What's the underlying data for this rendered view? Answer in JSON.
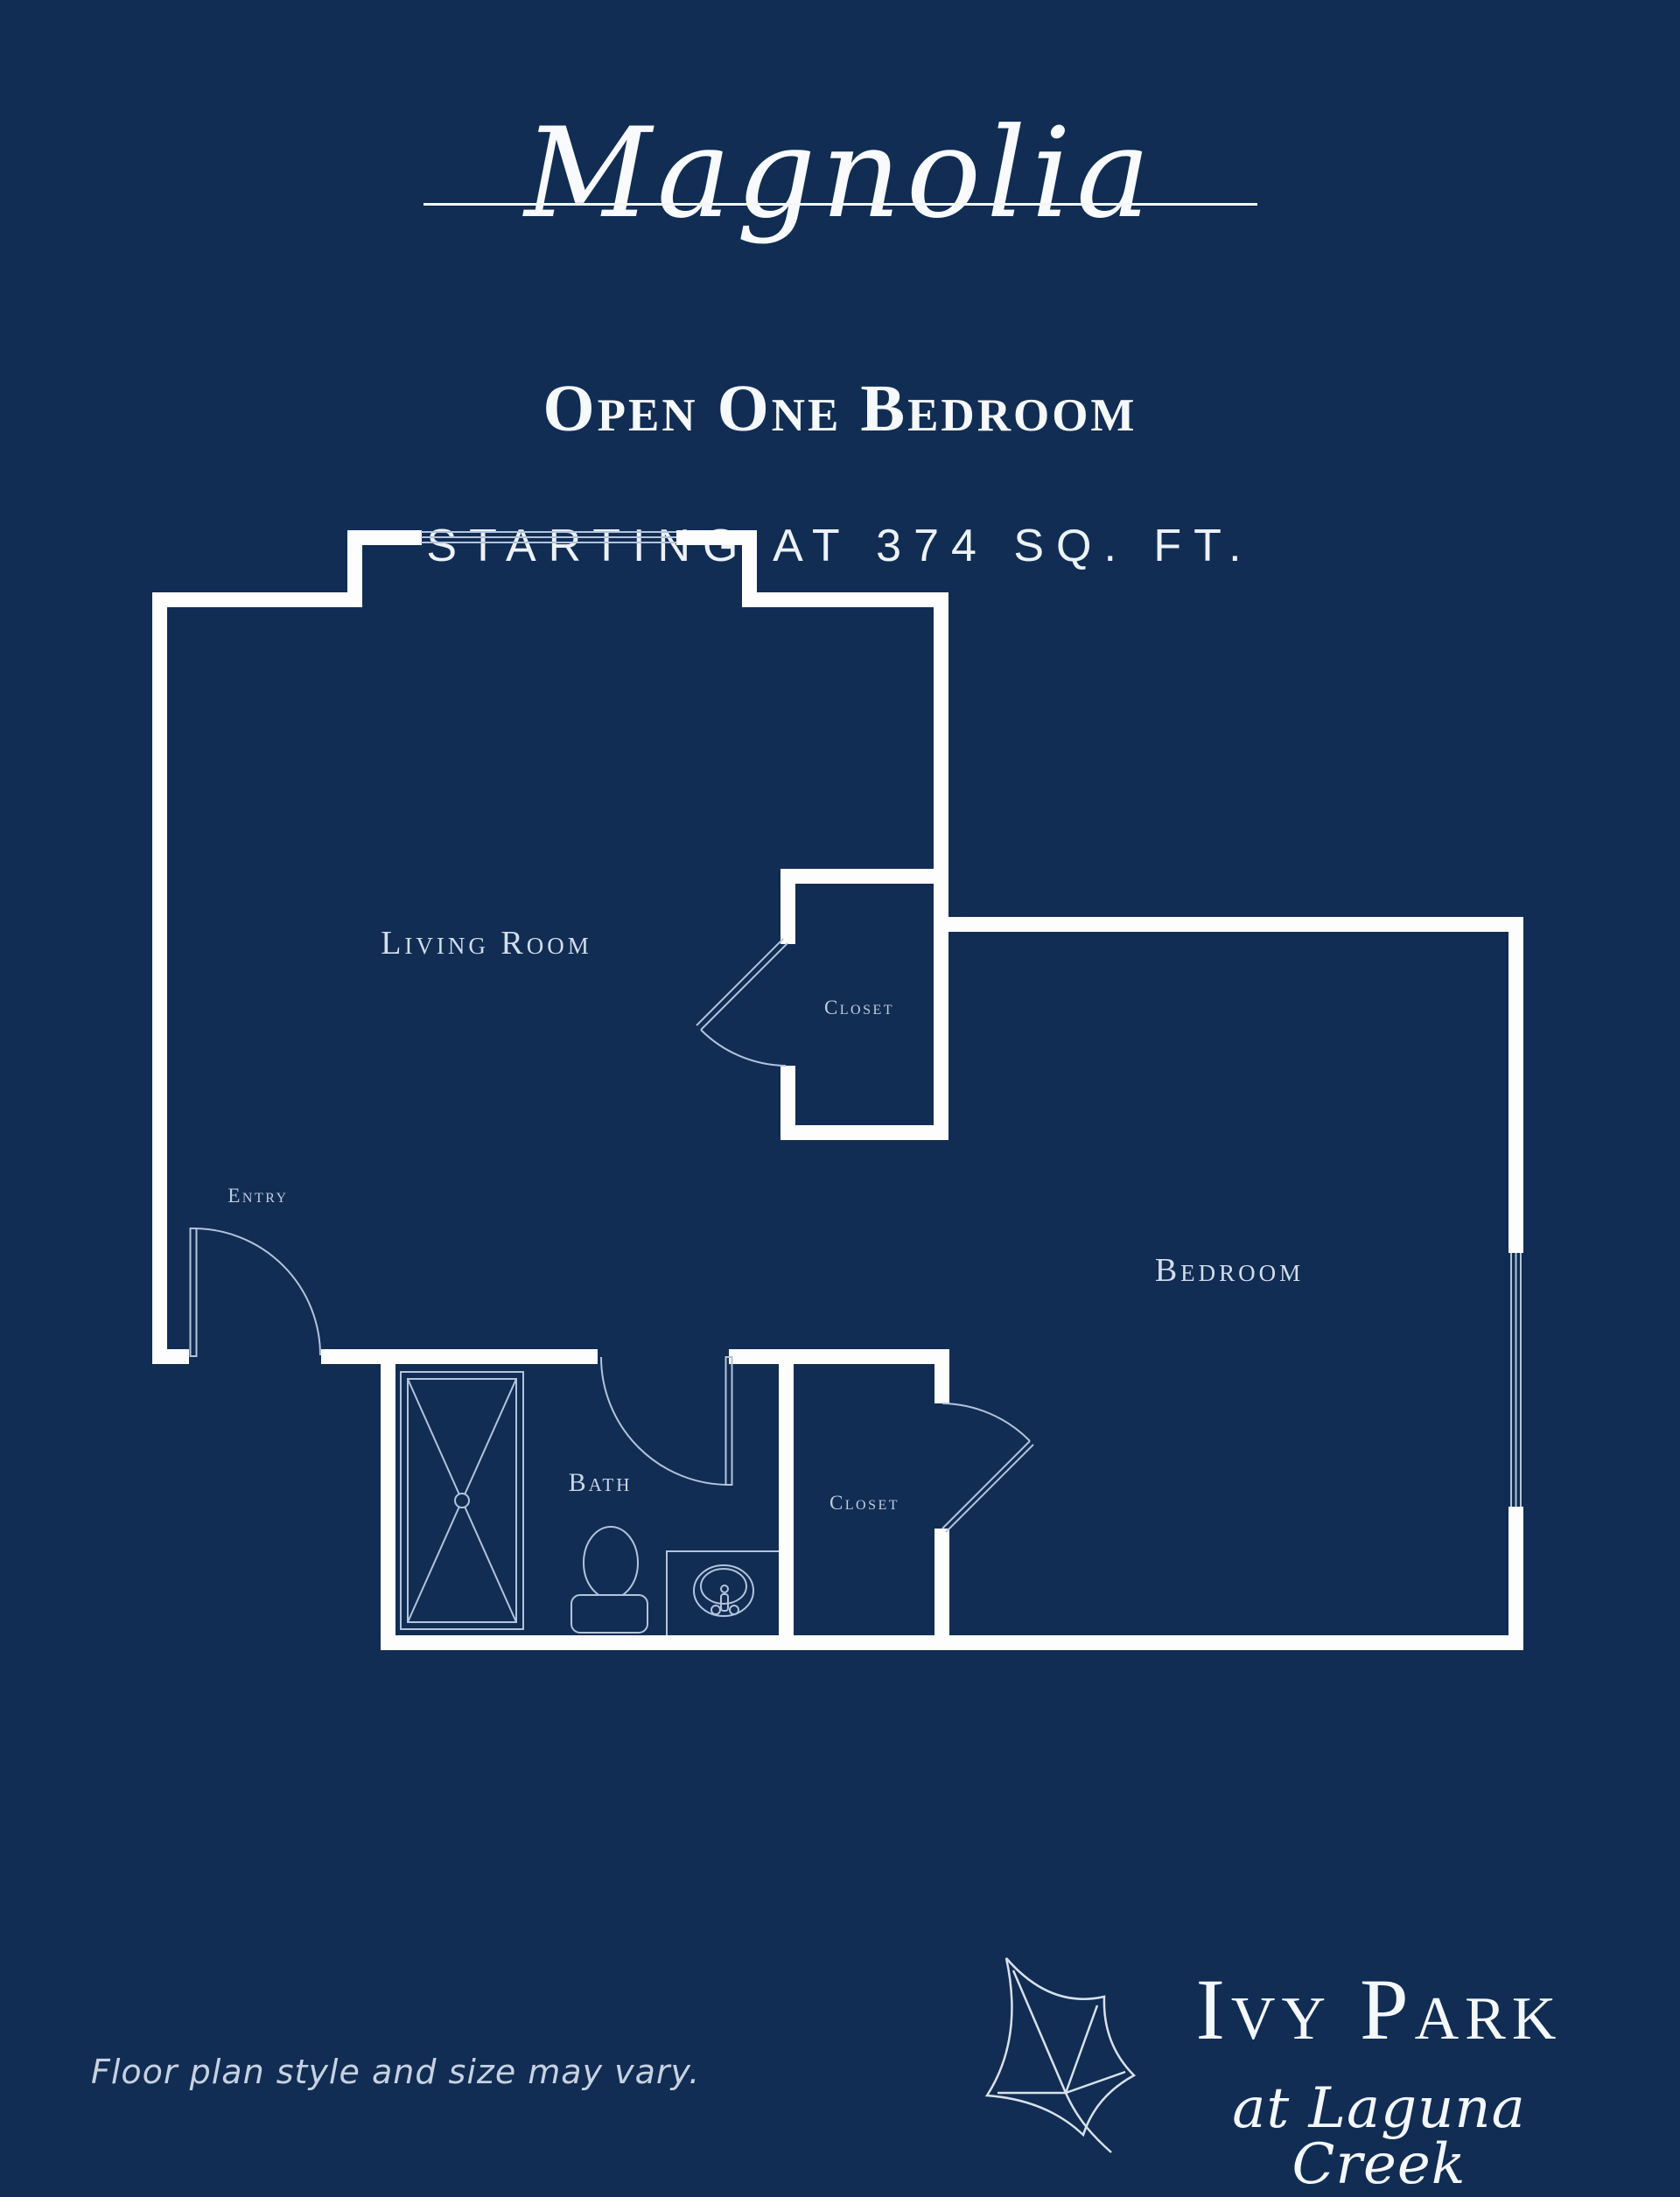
{
  "header": {
    "plan_name": "Magnolia",
    "plan_type": "Open One Bedroom",
    "plan_size": "STARTING AT 374 SQ. FT."
  },
  "floor_plan": {
    "labels": {
      "living_room": "Living Room",
      "closet_upper": "Closet",
      "entry": "Entry",
      "bath": "Bath",
      "closet_lower": "Closet",
      "bedroom": "Bedroom"
    }
  },
  "footer": {
    "disclaimer": "Floor plan style and size may vary.",
    "logo": {
      "name": "Ivy Park",
      "location": "at Laguna Creek"
    }
  },
  "colors": {
    "background": "#112D54",
    "walls": "#FDFDFE",
    "thin_lines": "#B4C3DB",
    "room_labels": "#CBD6E6",
    "title_text": "#F6F9FC"
  }
}
